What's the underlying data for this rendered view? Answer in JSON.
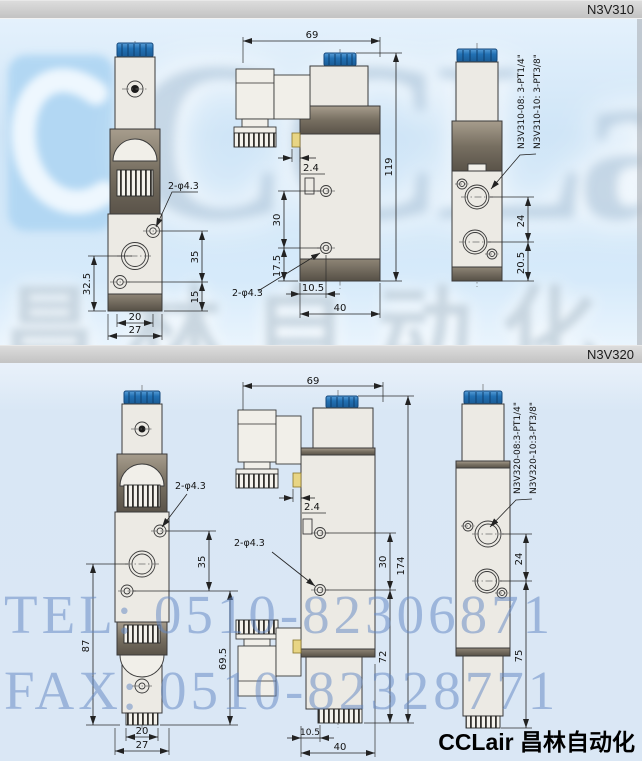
{
  "header": {
    "model_top": "N3V310",
    "model_bottom": "N3V320"
  },
  "watermarks": {
    "brand_big": "CCLair",
    "brand_cn": "昌林自动化",
    "tel": "TEL: 0510-82306871",
    "fax": "FAX: 0510-82328771"
  },
  "footer": {
    "brand": "CCLair 昌林自动化"
  },
  "colors": {
    "accent_blue": "#2271b4",
    "page_blue": "#d7e9f8",
    "bar_gray": "#c9c9c9",
    "watermark_blue": "#6d8cc3"
  },
  "n3v310": {
    "front": {
      "hole_label": "2-φ4.3",
      "dim_left": "32.5",
      "dim_right_upper": "35",
      "dim_right_lower": "15",
      "dim_width_inner": "20",
      "dim_width_outer": "27"
    },
    "side": {
      "dim_width": "69",
      "dim_height": "119",
      "dim_tab": "2.4",
      "dim_holes": "30",
      "dim_lower": "17.5",
      "hole_label": "2-φ4.3",
      "dim_port_offset": "10.5",
      "dim_depth": "40"
    },
    "rear": {
      "port_label_1": "N3V310-08: 3-PT1/4\"",
      "port_label_2": "N3V310-10: 3-PT3/8\"",
      "dim_ports": "24",
      "dim_lower": "20.5"
    }
  },
  "n3v320": {
    "front": {
      "hole_label": "2-φ4.3",
      "dim_right_upper": "35",
      "dim_left": "87",
      "dim_right_lower": "69.5",
      "dim_width_inner": "20",
      "dim_width_outer": "27"
    },
    "side": {
      "dim_width": "69",
      "dim_height": "174",
      "dim_tab": "2.4",
      "hole_label": "2-φ4.3",
      "dim_holes": "30",
      "dim_lower": "72",
      "dim_port_offset": "10.5",
      "dim_depth": "40"
    },
    "rear": {
      "port_label_1": "N3V320-08:3-PT1/4\"",
      "port_label_2": "N3V320-10:3-PT3/8\"",
      "dim_ports": "24",
      "dim_lower": "75"
    }
  }
}
